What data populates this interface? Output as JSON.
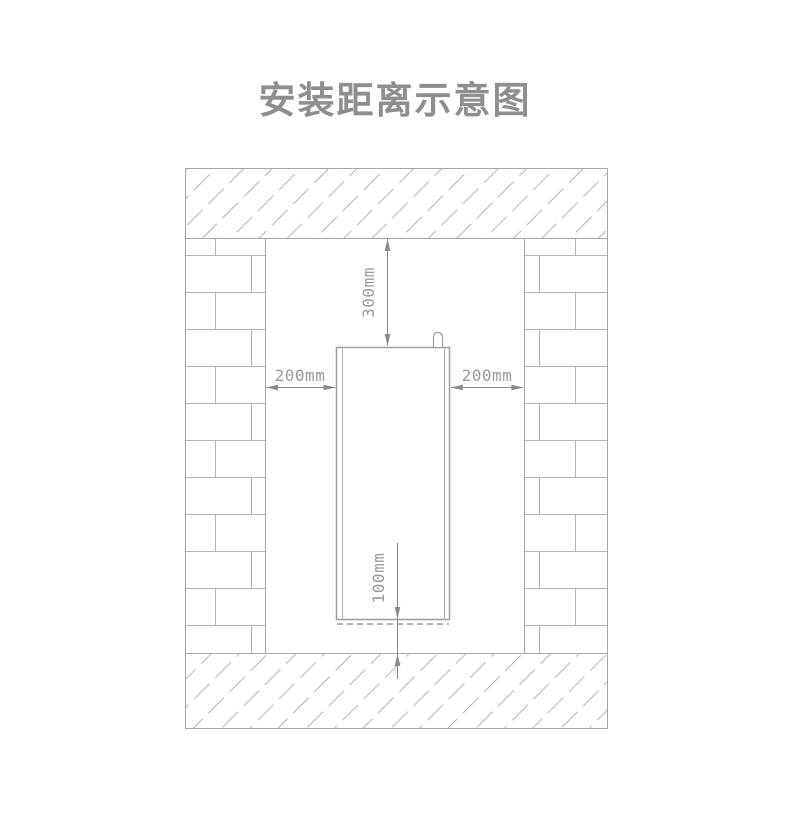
{
  "page": {
    "title": "安装距离示意图"
  },
  "diagram": {
    "type": "installation-clearance-diagram",
    "dimensions": {
      "top": "300mm",
      "left": "200mm",
      "right": "200mm",
      "bottom": "100mm"
    },
    "colors": {
      "background": "#ffffff",
      "title_text": "#8e8e8e",
      "wall_pattern_line": "#b4b4b4",
      "section_border": "#a6a6a6",
      "appliance_outline": "#9e9e9e",
      "dimension_line": "#8a8a8a",
      "dimension_text": "#9a9a9a"
    }
  }
}
